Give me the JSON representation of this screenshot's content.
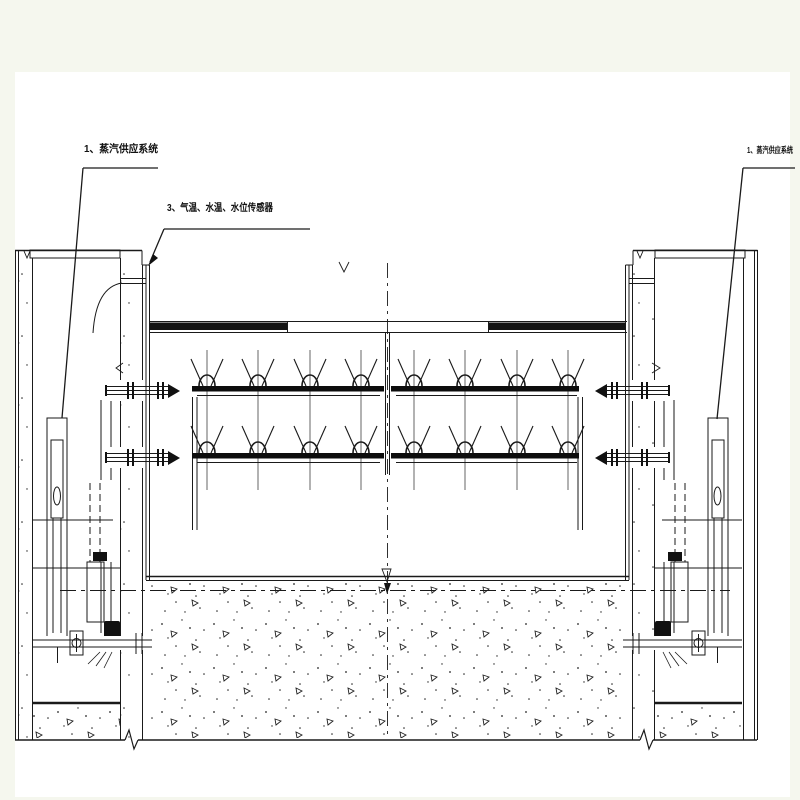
{
  "annotations": {
    "steam_supply_left": "1、蒸汽供应系统",
    "temp_water_level_sensors": "3、气温、水温、水位传感器",
    "steam_supply_right": "1、蒸汽供应系统"
  },
  "colors": {
    "line": "#1a1a1a",
    "page_background": "#f5f7ee",
    "canvas_background": "#ffffff"
  }
}
